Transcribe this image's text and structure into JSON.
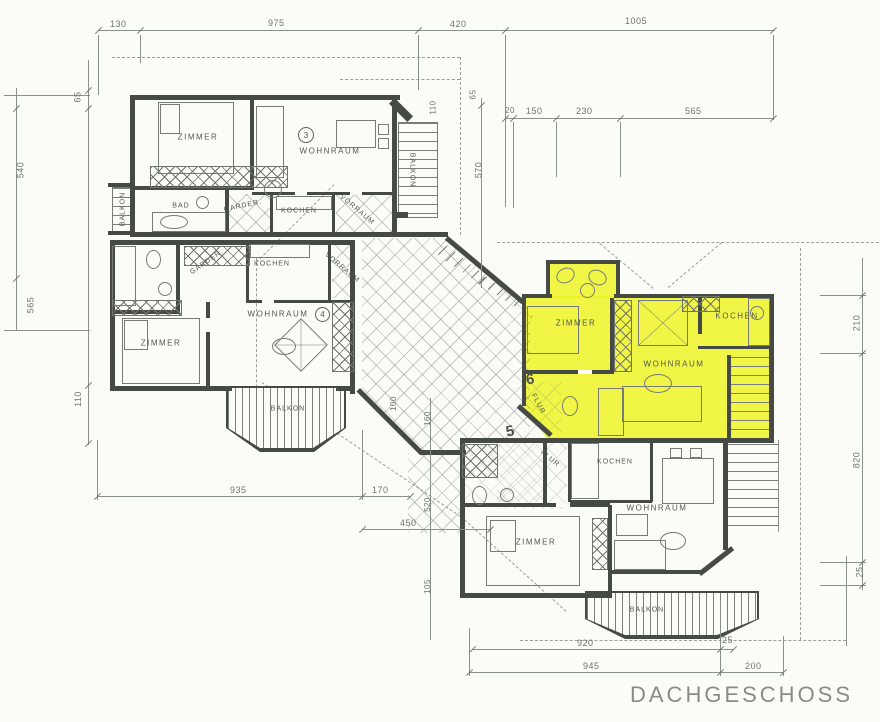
{
  "title": "DACHGESCHOSS",
  "units": {
    "u3": "3",
    "u4": "4",
    "u5": "5",
    "u6": "6"
  },
  "apartments": {
    "a3": {
      "zimmer": "ZIMMER",
      "wohnraum": "WOHNRAUM",
      "bad": "BAD",
      "garderobe": "GARDER.",
      "kochen": "KOCHEN",
      "vorraum": "VORRAUM",
      "balkon_left": "BALKON",
      "balkon_right": "BALKON"
    },
    "a4": {
      "zimmer": "ZIMMER",
      "wohnraum": "WOHNRAUM",
      "kochen": "KOCHEN",
      "garderobe": "GARDER.",
      "vorraum": "VORRAUM",
      "balkon": "BALKON"
    },
    "a6": {
      "zimmer": "ZIMMER",
      "wohnraum": "WOHNRAUM",
      "kochen": "KOCHEN",
      "flur": "FLUR"
    },
    "a5": {
      "zimmer": "ZIMMER",
      "wohnraum": "WOHNRAUM",
      "kochen": "KOCHEN",
      "flur": "FLUR",
      "balkon": "BALKON"
    }
  },
  "dims": {
    "top": [
      "130",
      "975",
      "420",
      "1005"
    ],
    "top_right": [
      "20",
      "150",
      "230",
      "565"
    ],
    "left": [
      "65",
      "540",
      "565",
      "110"
    ],
    "mid": [
      "110",
      "65",
      "570"
    ],
    "right": [
      "210",
      "820",
      "25"
    ],
    "bottom_left": [
      "935",
      "170",
      "450"
    ],
    "mid_right": [
      "100",
      "160",
      "520",
      "105"
    ],
    "bottom": [
      "920",
      "25",
      "945",
      "200"
    ]
  },
  "colors": {
    "highlight": "#edf31f",
    "wall": "#454b44",
    "line": "#8a908a",
    "dim_text": "#6f756d",
    "title_text": "#878d86"
  }
}
